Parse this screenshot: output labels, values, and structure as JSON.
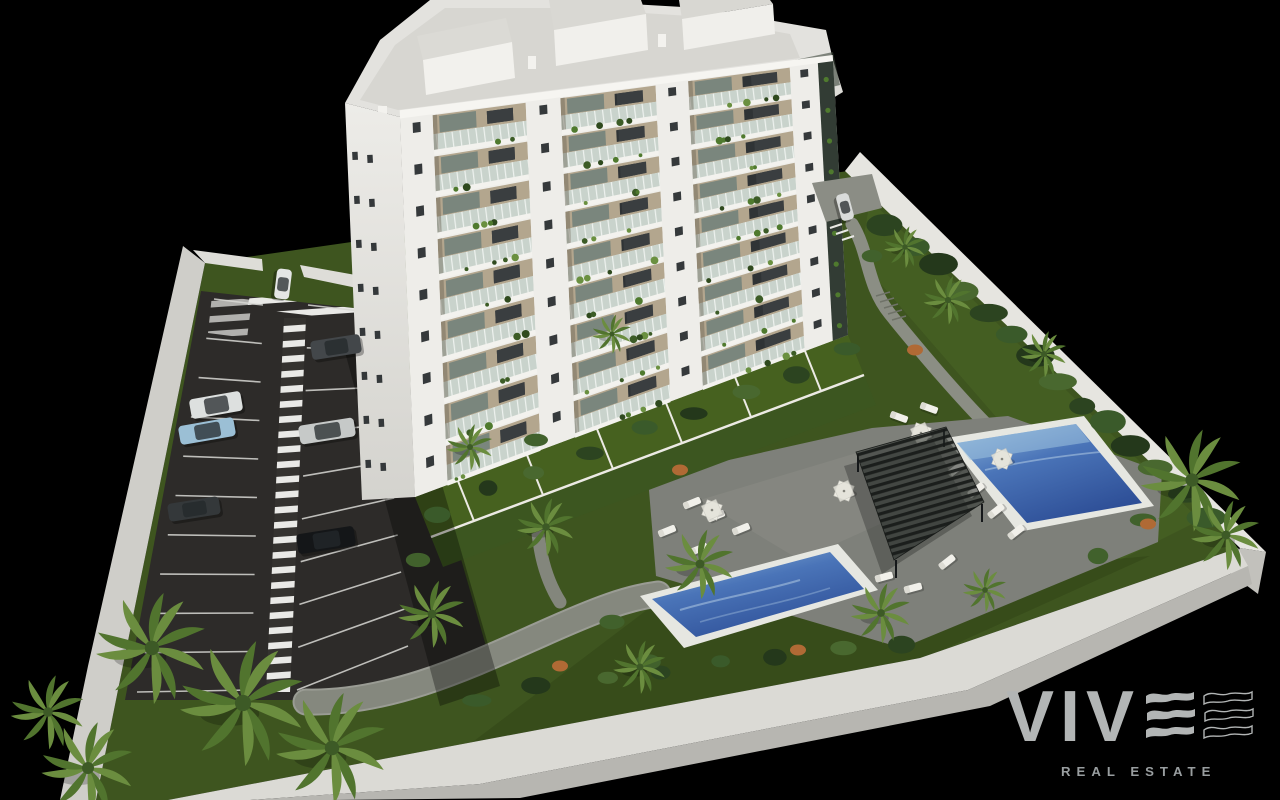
{
  "canvas": {
    "width": 1280,
    "height": 800,
    "background": "#000000"
  },
  "logo": {
    "brand": "VIVE",
    "displayed_letters": "VIV",
    "tagline": "REAL ESTATE",
    "letter_color": "#b2b5b5",
    "tagline_color": "#999ea0",
    "wave_bars_filled": 3,
    "wave_bars_outlined": 3
  },
  "scene": {
    "setting": "aerial 3D architectural render of a white apartment complex on a black background",
    "colors": {
      "lawn": "#3e551f",
      "asphalt": "#2d2b29",
      "parking_lines": "#d8d8d4",
      "wall_top": "#dbdad5",
      "wall_face": "#b7b6b1",
      "facade_white": "#efeeea",
      "balcony_recess": "#b3a68e",
      "railing_glass": "#c9d3cb",
      "roof": "#d7d6d1",
      "deck": "#7e807a",
      "pool_rim": "#e6e7e1",
      "pool_water_deep": "#2e4f97",
      "pool_water_shallow": "#8fb7da",
      "pergola": "#171a18",
      "palm_fronds": [
        "#6b8d3f",
        "#51742e"
      ],
      "accent_bush_orange": "#b06a35"
    },
    "building": {
      "type": "white residential tower with balconies and roof terraces",
      "visible_floors": 9,
      "piers": [
        [
          0.0,
          0.075
        ],
        [
          0.29,
          0.37
        ],
        [
          0.59,
          0.665
        ],
        [
          0.9,
          0.965
        ]
      ],
      "bays": [
        [
          0.075,
          0.29
        ],
        [
          0.37,
          0.59
        ],
        [
          0.665,
          0.9
        ]
      ]
    },
    "parking": {
      "stalls": {
        "left": {
          "n": 11,
          "s0": [
            214,
            299
          ],
          "s1": [
            137,
            692
          ],
          "e0": [
            263,
            305
          ],
          "e1": [
            251,
            690
          ]
        },
        "right": {
          "n": 10,
          "s0": [
            308,
            305
          ],
          "s1": [
            297,
            690
          ],
          "e0": [
            377,
            313
          ],
          "e1": [
            408,
            646
          ]
        }
      },
      "cars": [
        {
          "name": "white-hatchback-entrance",
          "x": 283,
          "y": 284,
          "rot": 97,
          "len": 30,
          "wid": 15,
          "body": "#e4e6e5"
        },
        {
          "name": "dark-gray-sedan",
          "x": 336,
          "y": 347,
          "rot": -9,
          "len": 50,
          "wid": 19,
          "body": "#43474a"
        },
        {
          "name": "white-suv",
          "x": 216,
          "y": 405,
          "rot": -10,
          "len": 52,
          "wid": 20,
          "body": "#dde0df"
        },
        {
          "name": "light-blue-sedan",
          "x": 207,
          "y": 431,
          "rot": -10,
          "len": 56,
          "wid": 19,
          "body": "#9bbfd5"
        },
        {
          "name": "silver-sedan",
          "x": 327,
          "y": 431,
          "rot": -9,
          "len": 56,
          "wid": 19,
          "body": "#c6c9c8"
        },
        {
          "name": "dark-gray-car",
          "x": 194,
          "y": 509,
          "rot": -9,
          "len": 52,
          "wid": 18,
          "body": "#34383a"
        },
        {
          "name": "black-sedan",
          "x": 326,
          "y": 540,
          "rot": -9,
          "len": 58,
          "wid": 20,
          "body": "#141618"
        },
        {
          "name": "white-car-driveway",
          "x": 845,
          "y": 207,
          "rot": 75,
          "len": 27,
          "wid": 13,
          "body": "#d9dbda"
        }
      ]
    },
    "pools": [
      {
        "name": "long-pool-lower",
        "rim": "#e6e7e1"
      },
      {
        "name": "upper-right-pool",
        "rim": "#e6e7e1"
      }
    ],
    "furniture": {
      "parasols": [
        {
          "x": 921,
          "y": 433
        },
        {
          "x": 1002,
          "y": 459
        },
        {
          "x": 712,
          "y": 510
        },
        {
          "x": 844,
          "y": 491
        }
      ],
      "loungers": [
        {
          "x": 692,
          "y": 503,
          "rot": -22
        },
        {
          "x": 716,
          "y": 516,
          "rot": -22
        },
        {
          "x": 741,
          "y": 529,
          "rot": -22
        },
        {
          "x": 667,
          "y": 531,
          "rot": -22
        },
        {
          "x": 699,
          "y": 549,
          "rot": -22
        },
        {
          "x": 956,
          "y": 469,
          "rot": -38
        },
        {
          "x": 976,
          "y": 490,
          "rot": -38
        },
        {
          "x": 996,
          "y": 511,
          "rot": -38
        },
        {
          "x": 1016,
          "y": 532,
          "rot": -38
        },
        {
          "x": 884,
          "y": 577,
          "rot": -15
        },
        {
          "x": 913,
          "y": 588,
          "rot": -15
        },
        {
          "x": 947,
          "y": 562,
          "rot": -38
        },
        {
          "x": 899,
          "y": 417,
          "rot": 20
        },
        {
          "x": 929,
          "y": 408,
          "rot": 20
        }
      ]
    },
    "vegetation": {
      "palms": [
        {
          "x": 152,
          "y": 648,
          "s": 2.4
        },
        {
          "x": 243,
          "y": 703,
          "s": 2.7
        },
        {
          "x": 332,
          "y": 748,
          "s": 2.4
        },
        {
          "x": 88,
          "y": 768,
          "s": 2.0
        },
        {
          "x": 48,
          "y": 712,
          "s": 1.6
        },
        {
          "x": 700,
          "y": 564,
          "s": 1.5
        },
        {
          "x": 546,
          "y": 527,
          "s": 1.25
        },
        {
          "x": 432,
          "y": 614,
          "s": 1.45
        },
        {
          "x": 470,
          "y": 447,
          "s": 1.0
        },
        {
          "x": 612,
          "y": 334,
          "s": 0.85
        },
        {
          "x": 948,
          "y": 300,
          "s": 1.05
        },
        {
          "x": 1044,
          "y": 354,
          "s": 1.0
        },
        {
          "x": 881,
          "y": 613,
          "s": 1.3
        },
        {
          "x": 1192,
          "y": 480,
          "s": 2.2
        },
        {
          "x": 1226,
          "y": 535,
          "s": 1.5
        },
        {
          "x": 640,
          "y": 667,
          "s": 1.15
        },
        {
          "x": 905,
          "y": 247,
          "s": 0.9
        },
        {
          "x": 985,
          "y": 590,
          "s": 0.95
        }
      ],
      "hedge_row": {
        "from": [
          886,
          222
        ],
        "to": [
          1208,
          516
        ],
        "n": 14
      },
      "bush_rows": [
        {
          "from": [
            436,
            512
          ],
          "to": [
            842,
            352
          ],
          "n": 9
        },
        {
          "from": [
            482,
            696
          ],
          "to": [
            900,
            640
          ],
          "n": 8
        }
      ],
      "green_bushes": [
        {
          "x": 648,
          "y": 662
        },
        {
          "x": 1143,
          "y": 520
        },
        {
          "x": 1098,
          "y": 556
        },
        {
          "x": 612,
          "y": 622
        },
        {
          "x": 418,
          "y": 560
        },
        {
          "x": 536,
          "y": 440
        },
        {
          "x": 872,
          "y": 256
        }
      ],
      "orange_bushes": [
        {
          "x": 560,
          "y": 666
        },
        {
          "x": 798,
          "y": 650
        },
        {
          "x": 1148,
          "y": 524
        },
        {
          "x": 680,
          "y": 470
        },
        {
          "x": 915,
          "y": 350
        }
      ]
    }
  }
}
